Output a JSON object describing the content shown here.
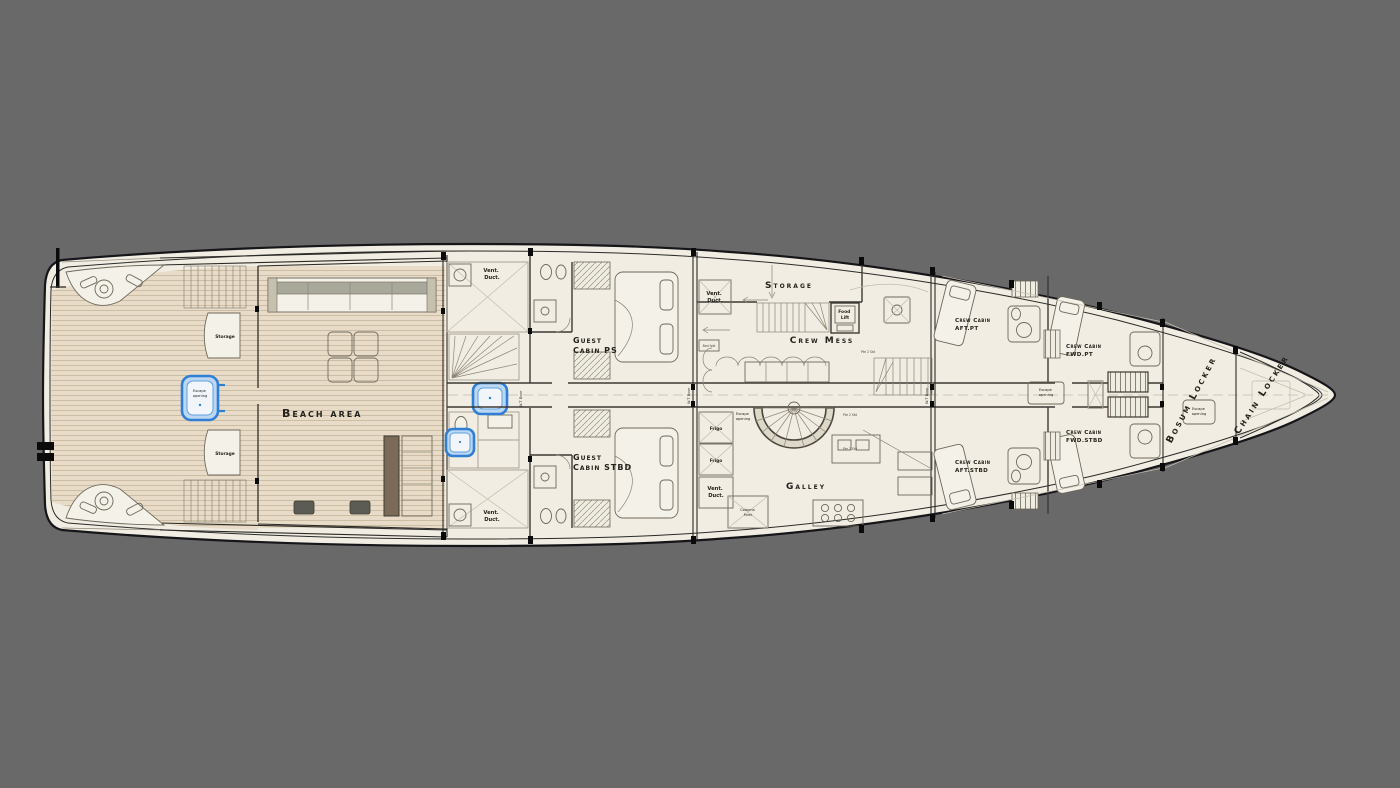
{
  "colors": {
    "background": "#696969",
    "hull_fill": "#f1ede2",
    "teak_fill": "#e8dcc9",
    "highlight_blue": "#2f7fd4",
    "line_ink": "#15151a"
  },
  "plan": {
    "aft": {
      "storage_top": "Storage",
      "storage_bottom": "Storage",
      "beach_area": "Beach area",
      "escape": {
        "l1": "Escape",
        "l2": "opening"
      }
    },
    "mid": {
      "vent_duct": {
        "l1": "Vent.",
        "l2": "Duct."
      },
      "wt_door": "W.T Door",
      "guest_cabin_ps": {
        "l1": "Guest",
        "l2": "Cabin PS"
      },
      "guest_cabin_stbd": {
        "l1": "Guest",
        "l2": "Cabin STBD"
      },
      "bed_fold": "Bed fold"
    },
    "crew": {
      "storage": "Storage",
      "food_lift": {
        "l1": "Food",
        "l2": "Lift"
      },
      "crew_mess": "Crew Mess",
      "stair_note": "Pte 2 Std",
      "frigo": "Frigo",
      "galley": "Galley",
      "colonna_forni": {
        "l1": "Colonna",
        "l2": "Forni"
      },
      "escape_galley": {
        "l1": "Escape",
        "l2": "opening"
      },
      "escape_corridor": {
        "l1": "Escape",
        "l2": "opening"
      },
      "cabins": {
        "aft_pt": {
          "l1": "Crew Cabin",
          "l2": "AFT.PT"
        },
        "fwd_pt": {
          "l1": "Crew Cabin",
          "l2": "FWD.PT"
        },
        "aft_stbd": {
          "l1": "Crew Cabin",
          "l2": "AFT.STBD"
        },
        "fwd_stbd": {
          "l1": "Crew Cabin",
          "l2": "FWD.STBD"
        }
      }
    },
    "bow": {
      "bosum_locker": "Bosum Locker",
      "chain_locker": "Chain Locker",
      "escape": {
        "l1": "Escape",
        "l2": "opening"
      }
    }
  }
}
